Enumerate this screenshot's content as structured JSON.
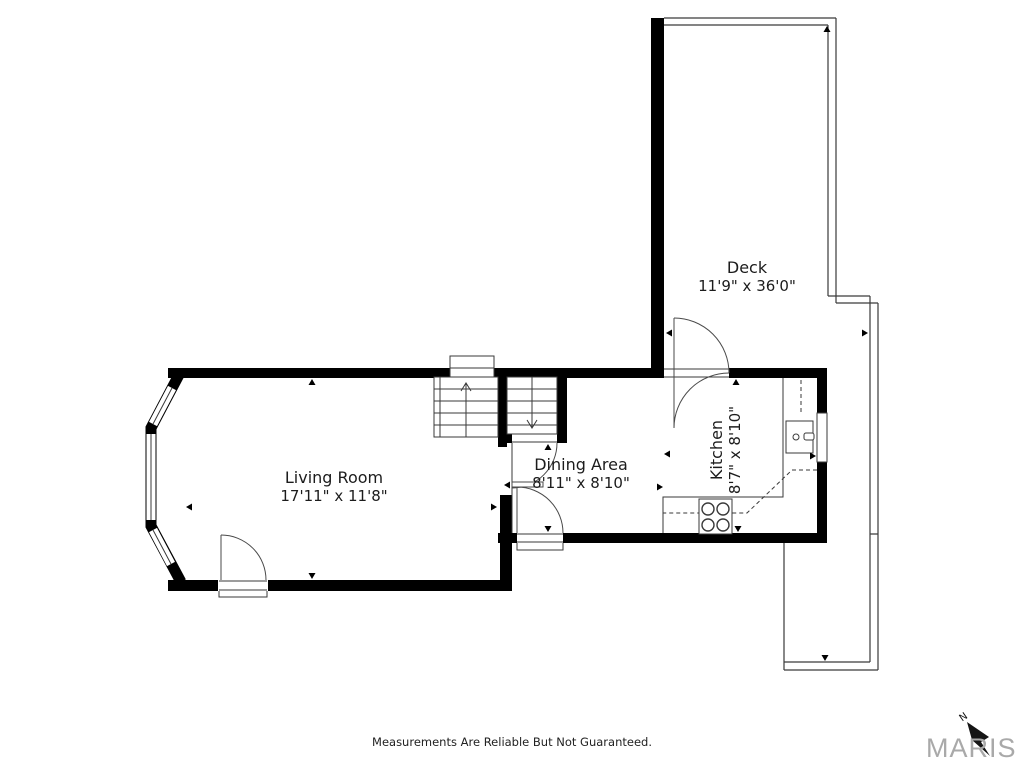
{
  "title": "Floor Plan",
  "rooms": [
    {
      "id": "living-room",
      "label": "Living Room",
      "dimensions": "17'11\" x 11'8\""
    },
    {
      "id": "dining-area",
      "label": "Dining Area",
      "dimensions": "8'11\" x 8'10\""
    },
    {
      "id": "kitchen",
      "label": "Kitchen",
      "dimensions": "8'7\" x 8'10\""
    },
    {
      "id": "deck",
      "label": "Deck",
      "dimensions": "11'9\" x 36'0\""
    }
  ],
  "features": {
    "stairs_up": "staircase with up arrow",
    "stairs_down": "staircase with down arrow",
    "fixtures": [
      "stove-4-burners",
      "kitchen-sink",
      "counter",
      "bay-window",
      "deck-railing"
    ]
  },
  "footer": {
    "disclaimer": "Measurements Are Reliable But Not Guaranteed."
  },
  "branding": {
    "logo_text": "MARIS",
    "compass_label": "N",
    "logo_color": "#a9a9a9"
  },
  "style": {
    "wall_color": "#000000",
    "line_color": "#3a3a3a",
    "text_color": "#1c1c1c",
    "background": "#ffffff"
  }
}
